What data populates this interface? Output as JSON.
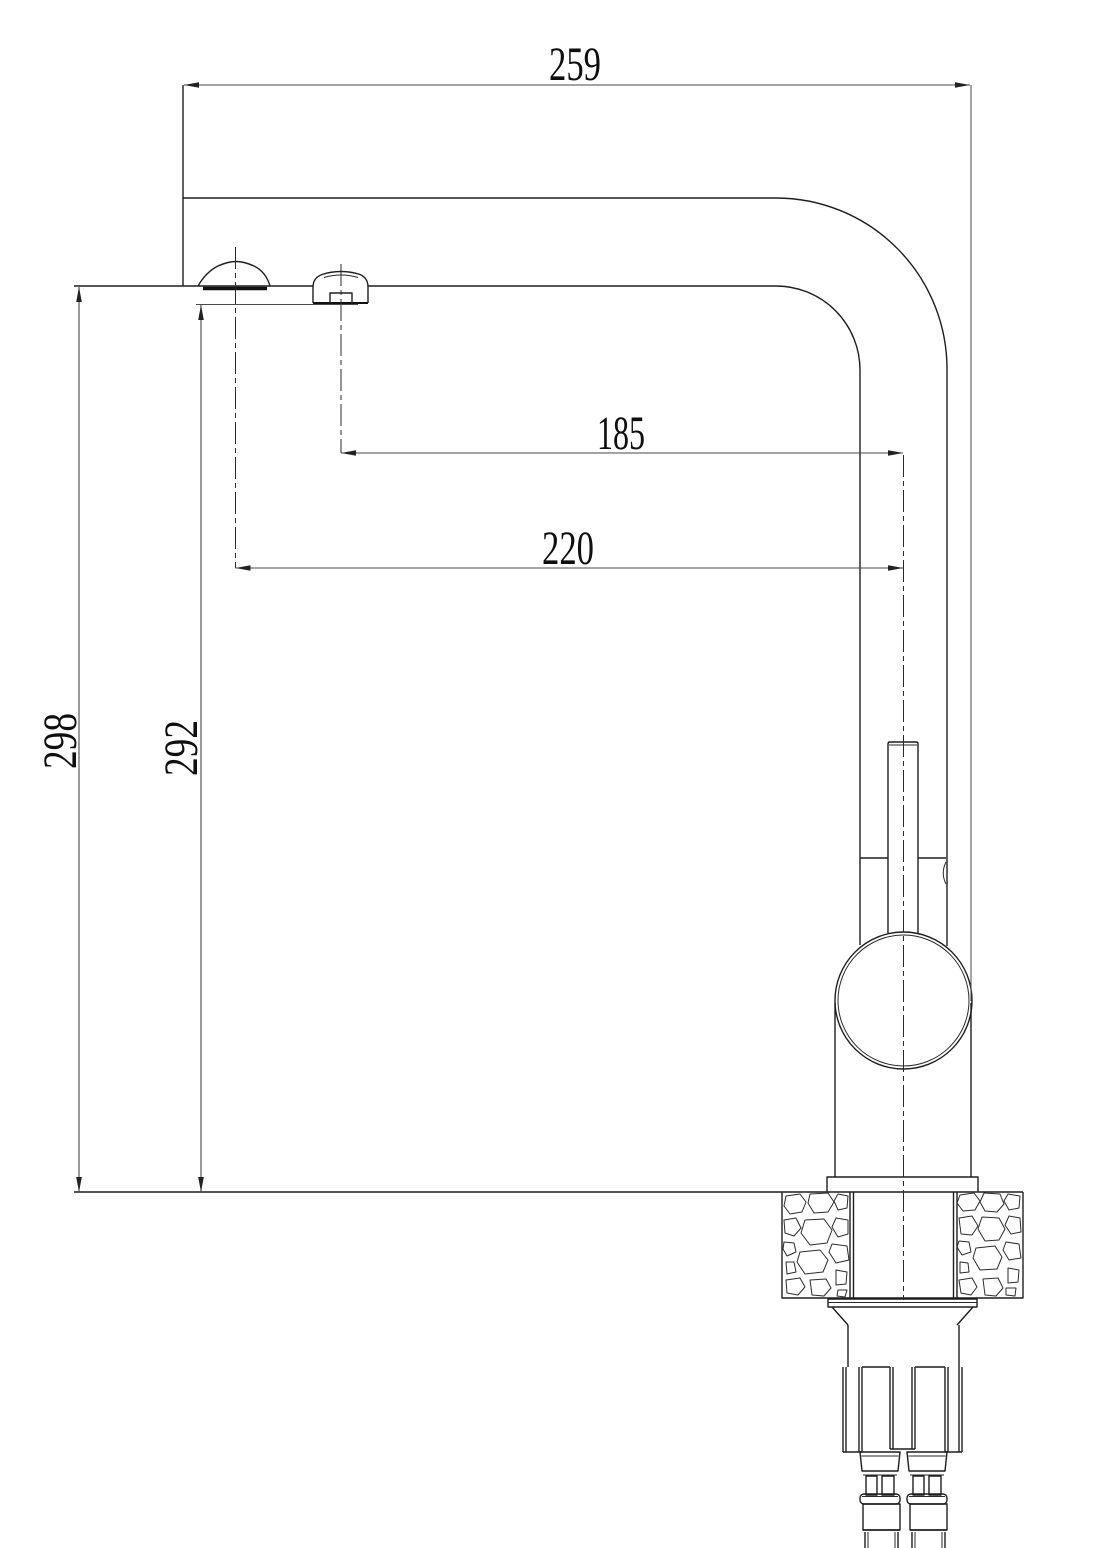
{
  "drawing": {
    "type": "technical-dimension-drawing",
    "subject": "single-lever kitchen mixer faucet, side elevation with countertop cross-section and mounting hardware",
    "units": "mm",
    "colors": {
      "line": "#1e1e1e",
      "dimension_line": "#4a4a4a",
      "background": "#ffffff"
    },
    "dimensions": {
      "overall_depth": "259",
      "spray_outlet_to_riser_axis": "185",
      "aerator_outlet_to_riser_axis": "220",
      "height_to_spout_underside": "298",
      "height_to_spray_outlet": "292"
    }
  }
}
